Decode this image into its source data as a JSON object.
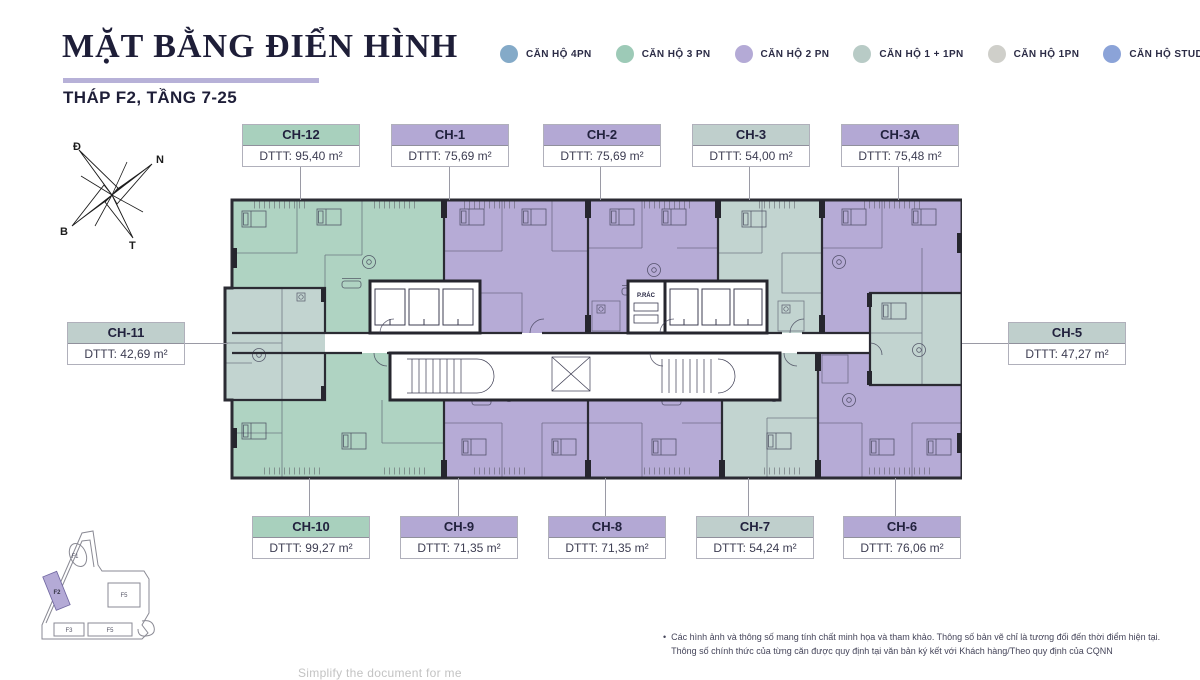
{
  "header": {
    "title": "MẶT BẰNG ĐIỂN HÌNH",
    "subtitle": "THÁP F2, TẦNG 7-25",
    "underline_color": "#b7b1d8"
  },
  "legend": {
    "items": [
      {
        "label": "CĂN HỘ 4PN",
        "color": "#84aac8"
      },
      {
        "label": "CĂN HỘ 3 PN",
        "color": "#9dcab7"
      },
      {
        "label": "CĂN HỘ 2 PN",
        "color": "#b4aad6"
      },
      {
        "label": "CĂN HỘ 1 + 1PN",
        "color": "#b8cbc6"
      },
      {
        "label": "CĂN HỘ 1PN",
        "color": "#cfcfca"
      },
      {
        "label": "CĂN HỘ STUDIO",
        "color": "#8ba3d8"
      }
    ]
  },
  "compass": {
    "d": "Đ",
    "n": "N",
    "b": "B",
    "t": "T"
  },
  "units": {
    "top": [
      {
        "id": "CH-12",
        "area": "DTTT: 95,40 m²",
        "type": "3PN"
      },
      {
        "id": "CH-1",
        "area": "DTTT: 75,69 m²",
        "type": "2PN"
      },
      {
        "id": "CH-2",
        "area": "DTTT: 75,69 m²",
        "type": "2PN"
      },
      {
        "id": "CH-3",
        "area": "DTTT: 54,00 m²",
        "type": "1+1PN"
      },
      {
        "id": "CH-3A",
        "area": "DTTT: 75,48 m²",
        "type": "2PN"
      }
    ],
    "left": {
      "id": "CH-11",
      "area": "DTTT: 42,69 m²",
      "type": "1+1PN"
    },
    "right": {
      "id": "CH-5",
      "area": "DTTT: 47,27 m²",
      "type": "1+1PN"
    },
    "bottom": [
      {
        "id": "CH-10",
        "area": "DTTT: 99,27 m²",
        "type": "3PN"
      },
      {
        "id": "CH-9",
        "area": "DTTT: 71,35 m²",
        "type": "2PN"
      },
      {
        "id": "CH-8",
        "area": "DTTT: 71,35 m²",
        "type": "2PN"
      },
      {
        "id": "CH-7",
        "area": "DTTT: 54,24 m²",
        "type": "1+1PN"
      },
      {
        "id": "CH-6",
        "area": "DTTT: 76,06 m²",
        "type": "2PN"
      }
    ]
  },
  "plan": {
    "trash_room": "P.RÁC",
    "fill_3pn": "#afd3c2",
    "fill_2pn": "#b6abd6",
    "fill_1_1pn": "#c2d4d0",
    "wall_color": "#2b2b33"
  },
  "sitemap": {
    "labels": {
      "f1": "F1",
      "f2": "F2",
      "f5_right": "F5",
      "f3": "F3",
      "f5_bottom": "F5"
    },
    "highlight_color": "#b4aad6"
  },
  "footnote": {
    "bullet": "•",
    "line1": "Các hình ảnh và thông số mang tính chất minh họa và tham khảo. Thông số bản vẽ chỉ là tương đối đến thời điểm hiện tại.",
    "line2": "Thông số chính thức của từng căn được quy định tại văn bản ký kết với Khách hàng/Theo quy định của CQNN"
  },
  "watermark": "Simplify the document for me"
}
